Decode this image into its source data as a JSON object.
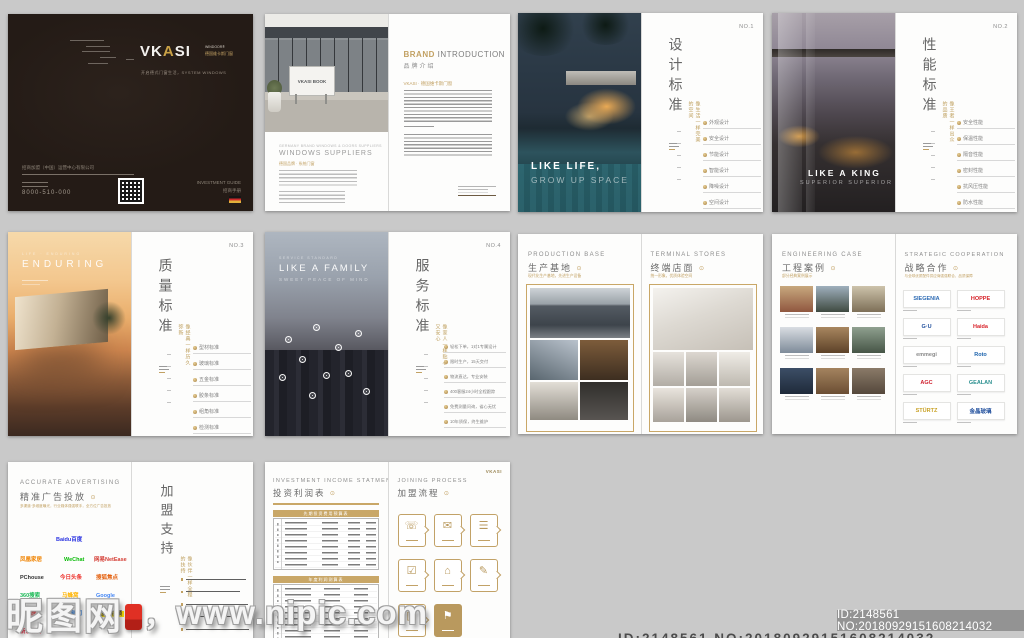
{
  "canvas": {
    "bg": "#c9c9c9",
    "accent_gold": "#c2a163",
    "cover_bg": "#241b16"
  },
  "watermark": {
    "site": "昵图网",
    "sep": "，",
    "url": "www.nipic.com"
  },
  "idbar": {
    "text": "ID:2148561 NO:20180929151608214032"
  },
  "bottom_cut": {
    "text": "ID:2148561 NO:20180929151608214032"
  },
  "cover": {
    "brand_pre": "VK",
    "brand_mid": "A",
    "brand_post": "SI",
    "sub1": "WINDOOR®",
    "sub2": "德国维卡斯门窗",
    "tagline": "开启德式门窗生活，SYSTEM WINDOWS",
    "company": "招商加盟（中国）运营中心有限公司",
    "phone": "8000-510-000",
    "guide_en": "INVESTMENT GUIDE",
    "guide_cn": "招商手册"
  },
  "brand": {
    "sign_text": "VKASI BOOK",
    "left_small": "GERMANY BRAND WINDOWS & DOORS SUPPLIERS",
    "left_title": "WINDOWS SUPPLIERS",
    "left_gold": "德国品牌 · 系统门窗",
    "title_gold": "BRAND",
    "title_rest": " INTRODUCTION",
    "subtitle": "品牌介绍",
    "para_gold": "VKASI · 德国维卡斯门窗"
  },
  "design": {
    "no": "NO.1",
    "title": "设计标准",
    "gold_v": "像生活一样完美的空间",
    "hero1": "LIKE LIFE,",
    "hero2": "GROW UP SPACE",
    "items": [
      "外观设计",
      "安全设计",
      "节能设计",
      "智能设计",
      "降噪设计",
      "空间设计"
    ]
  },
  "performance": {
    "no": "NO.2",
    "title": "性能标准",
    "gold_v": "像王者一样出众的品质",
    "hero1": "LIKE A KING",
    "hero2": "SUPERIOR SUPERIOR",
    "items": [
      "安全性能",
      "保温性能",
      "隔音性能",
      "密封性能",
      "抗风压性能",
      "防水性能"
    ]
  },
  "quality": {
    "no": "NO.3",
    "title": "质量标准",
    "gold_v": "像经典一样历久弥新",
    "hero_small": "LIFE · ENDURING",
    "hero1": "ENDURING",
    "items": [
      "型材标准",
      "玻璃标准",
      "五金标准",
      "胶条标准",
      "组角标准",
      "检测标准"
    ]
  },
  "service": {
    "no": "NO.4",
    "title": "服务标准",
    "gold_v": "像家人一样贴心又安心",
    "hero_small": "SERVICE STANDARD",
    "hero1": "LIKE A FAMILY",
    "hero2": "SWEET PEACE OF MIND",
    "items": [
      "轻松下单，1对1专属设计",
      "限时生产，15天交付",
      "物流直达，专业安装",
      "400客服24小时全程跟踪",
      "免费测量问询，省心无忧",
      "10年质保，终生维护"
    ]
  },
  "production": {
    "en": "PRODUCTION BASE",
    "cn": "生产基地",
    "gold": "现代化生产基地，先进生产设备"
  },
  "stores": {
    "en": "TERMINAL STORES",
    "cn": "终端店面",
    "gold": "统一形象，优质体验空间"
  },
  "cases": {
    "en": "ENGINEERING CASE",
    "cn": "工程案例",
    "gold": "部分经典案例展示"
  },
  "cooperation": {
    "en": "STRATEGIC COOPERATION",
    "cn": "战略合作",
    "gold": "与全球优质配件供应商强强联合，品质保障",
    "logos": [
      {
        "text": "SIEGENIA",
        "style": "color:#2d6bb4"
      },
      {
        "text": "HOPPE",
        "style": "color:#d62027"
      },
      {
        "text": "G·U",
        "style": "color:#1f4e9c"
      },
      {
        "text": "Haida",
        "style": "color:#d8232a"
      },
      {
        "text": "emmegi",
        "style": "color:#8a8a8a"
      },
      {
        "text": "Roto",
        "style": "color:#1c63ad"
      },
      {
        "text": "AGC",
        "style": "color:#cf1f2e"
      },
      {
        "text": "GEALAN",
        "style": "color:#2a8f8f"
      },
      {
        "text": "STÜRTZ",
        "style": "color:#c9a227"
      },
      {
        "text": "金晶玻璃",
        "style": "color:#1f4e9c"
      }
    ]
  },
  "advertising": {
    "en": "ACCURATE ADVERTISING",
    "cn": "精准广告投放",
    "gold": "多渠道·多维度曝光，行业媒体强强联手，全方位广告投放",
    "logos": [
      {
        "text": "Baidu百度",
        "style": "color:#2932e1"
      },
      {
        "text": "凤凰家居",
        "style": "color:#f08300"
      },
      {
        "text": "WeChat",
        "style": "color:#09bb07"
      },
      {
        "text": "网易NetEase",
        "style": "color:#d43c33"
      },
      {
        "text": "PChouse",
        "style": "color:#333333"
      },
      {
        "text": "今日头条",
        "style": "color:#ed2f29"
      },
      {
        "text": "搜狐焦点",
        "style": "color:#e4610f"
      },
      {
        "text": "360搜索",
        "style": "color:#19b955"
      },
      {
        "text": "马蜂窝",
        "style": "color:#ffb400"
      },
      {
        "text": "Google",
        "style": "color:#4285f4"
      },
      {
        "text": "爱家居",
        "style": "color:#e0282e"
      },
      {
        "text": "腾讯新闻",
        "style": "color:#2a7de1"
      },
      {
        "text": "搜狐视频",
        "style": "background:#ffe400;color:#333;padding:0 2px"
      },
      {
        "text": "新浪微博",
        "style": "color:#e6162d"
      }
    ]
  },
  "support": {
    "title": "加盟支持",
    "gold_v": "像伙伴一样全程的扶持"
  },
  "income": {
    "en": "INVESTMENT INCOME STATMENT",
    "cn": "投资利润表",
    "t1_head": "先期投资费用预算表",
    "t2_head": "年度利润测算表"
  },
  "process": {
    "en": "JOINING PROCESS",
    "cn": "加盟流程",
    "brand": "VKASI",
    "steps": [
      {
        "name": "consult-icon",
        "glyph": "☏"
      },
      {
        "name": "apply-doc-icon",
        "glyph": "✉"
      },
      {
        "name": "review-icon",
        "glyph": "☰"
      },
      {
        "name": "sign-contract-icon",
        "glyph": "☑"
      },
      {
        "name": "store-location-icon",
        "glyph": "⌂"
      },
      {
        "name": "schedule-icon",
        "glyph": "✎"
      },
      {
        "name": "stocking-icon",
        "glyph": "▥"
      },
      {
        "name": "opening-icon",
        "glyph": "⚑"
      }
    ]
  },
  "glyphs": {
    "gold_dot": "⊙"
  }
}
